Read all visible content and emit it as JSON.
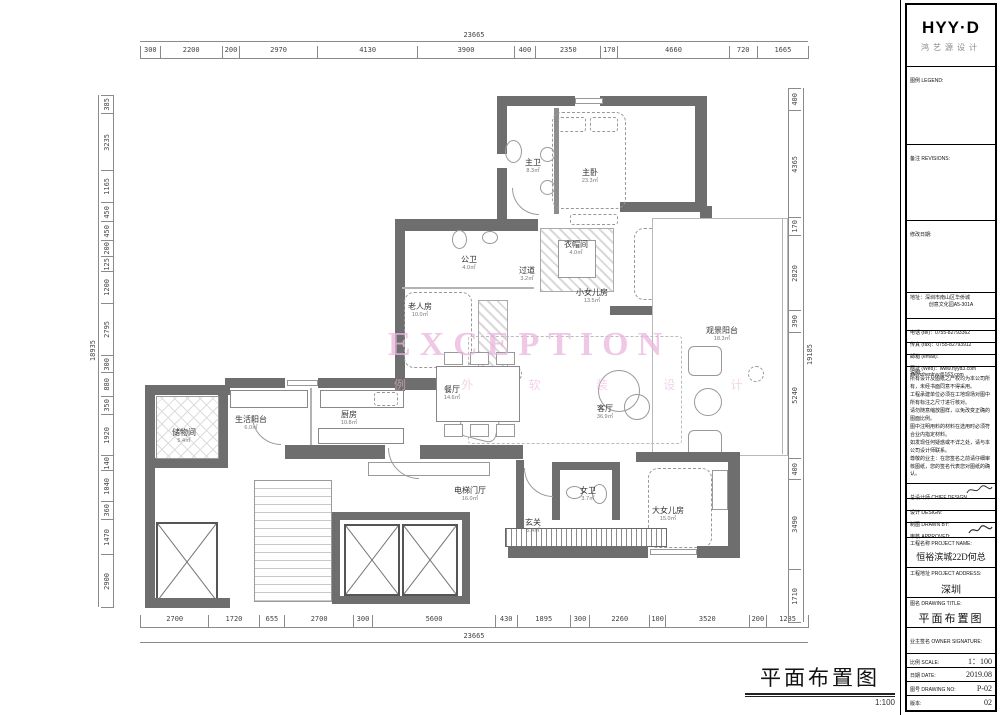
{
  "drawing": {
    "title": "平面布置图",
    "scale_note": "1:100",
    "watermark": {
      "en": "EXCEPTION",
      "zh": "例 外 软 装 设 计"
    }
  },
  "dims": {
    "top": {
      "overall": "23665",
      "segments": [
        300,
        2200,
        200,
        2970,
        4130,
        3900,
        400,
        2350,
        170,
        4660,
        720,
        1665
      ]
    },
    "bottom": {
      "overall": "23665",
      "segments": [
        2700,
        1720,
        655,
        2700,
        300,
        5600,
        430,
        1895,
        300,
        2260,
        100,
        3520,
        200,
        1285
      ]
    },
    "left": {
      "overall": "18935",
      "segments": [
        385,
        3235,
        1165,
        450,
        450,
        200,
        125,
        1200,
        2795,
        300,
        880,
        350,
        1920,
        140,
        1040,
        360,
        1470,
        2900
      ]
    },
    "right": {
      "overall": "19185",
      "segments": [
        400,
        4365,
        170,
        2820,
        390,
        5240,
        400,
        3490,
        1710
      ]
    }
  },
  "rooms": [
    {
      "name": "主卫",
      "area": "8.3㎡"
    },
    {
      "name": "主卧",
      "area": "23.3㎡"
    },
    {
      "name": "公卫",
      "area": "4.0㎡"
    },
    {
      "name": "过道",
      "area": "3.2㎡"
    },
    {
      "name": "衣帽间",
      "area": "4.0㎡"
    },
    {
      "name": "小女儿房",
      "area": "13.5㎡"
    },
    {
      "name": "老人房",
      "area": "10.0㎡"
    },
    {
      "name": "观景阳台",
      "area": "18.3㎡"
    },
    {
      "name": "餐厅",
      "area": "14.6㎡"
    },
    {
      "name": "客厅",
      "area": "36.9㎡"
    },
    {
      "name": "储物间",
      "area": "5.4㎡"
    },
    {
      "name": "生活阳台",
      "area": "6.0㎡"
    },
    {
      "name": "厨房",
      "area": "10.8㎡"
    },
    {
      "name": "电梯门厅",
      "area": "16.0㎡"
    },
    {
      "name": "玄关",
      "area": "5.4㎡"
    },
    {
      "name": "女卫",
      "area": "3.7㎡"
    },
    {
      "name": "大女儿房",
      "area": "15.0㎡"
    }
  ],
  "titleblock": {
    "logo": "HYY·D",
    "logo_sub": "鸿艺源设计",
    "legend_label": "图例 LEGEND:",
    "revisions_label": "备注 REVISIONS:",
    "revision_date_label": "修改日期:",
    "address_label": "地址：",
    "address_line1": "深圳市南山区华侨城",
    "address_line2": "创意文化园A5-301A",
    "tel": "电话 (tel)：0755-82793362",
    "fax": "传真 (fax)：0755-82793912",
    "email": "邮箱 (email)：shenzhenhyy@163.com",
    "web": "网址 (Web)：www.hyyd3.com",
    "notes_label": "说明:",
    "notes": [
      "所有设计及图纸之产权均为本公司所有，未经书面同意不得采用。",
      "工程承建单位必须在工地现场对图中所有标注之尺寸进行核对。",
      "请勿随意缩放图样，以免改变正确的图面比例。",
      "图中注明用料的材料在选用时必须符合业内指定材料。",
      "如发现任何疑惑或不详之处，请与本公司设计师联系。",
      "尊敬的业主：在您签名之前请仔细审核图纸，您的签名代表您对图纸的确认。"
    ],
    "chief_label": "总设计师 CHIEF DESIGN",
    "design_label": "设计 DESIGN:",
    "drawn_label": "制图 DRAWN BY:",
    "approved_label": "审核 APPROVED:",
    "project_name_label": "工程名称 PROJECT NAME:",
    "project_name": "恒裕滨城22D何总",
    "project_address_label": "工程地址 PROJECT ADDRESS:",
    "project_address": "深圳",
    "drawing_title_label": "图名 DRAWING TITLE:",
    "drawing_title": "平面布置图",
    "owner_label": "业主签名 OWNER SIGNATURE:",
    "scale_label": "比例 SCALE:",
    "scale_value": "1：100",
    "date_label": "日期 DATE:",
    "date_value": "2019.08",
    "no_label": "图号 DRAWING NO:",
    "no_value": "P-02",
    "version_label": "版本:",
    "version_value": "02"
  }
}
